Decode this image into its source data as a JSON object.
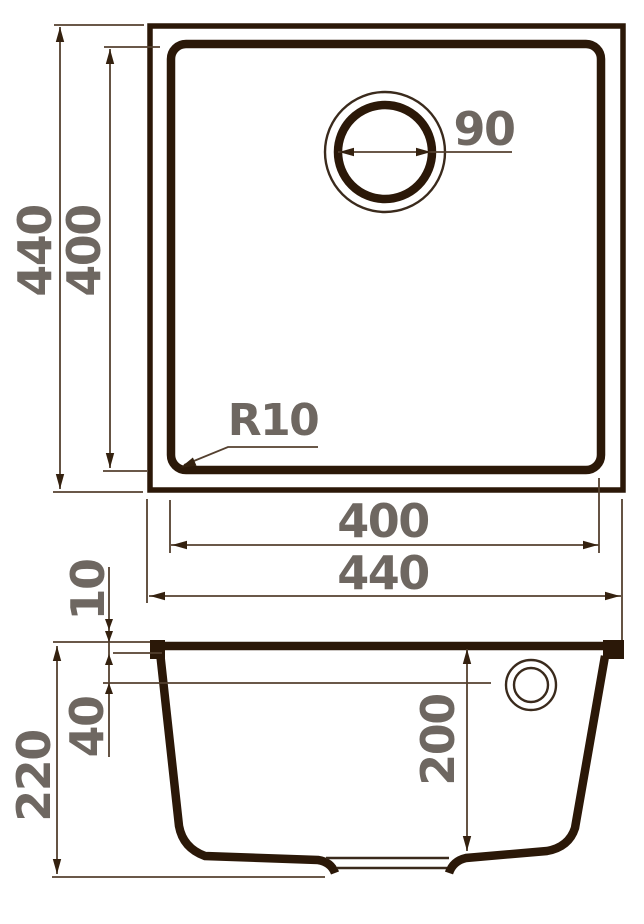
{
  "top_view": {
    "overall_width": "440",
    "overall_height": "440",
    "inner_width": "400",
    "inner_height": "400",
    "drain_diameter": "90",
    "corner_radius": "R10"
  },
  "section_view": {
    "overall_height": "220",
    "rim_thickness": "10",
    "overflow_offset": "40",
    "bowl_depth": "200"
  },
  "colors": {
    "outline": "#2b1808",
    "dimension_line": "#54402f",
    "arrow": "#34210f",
    "label_text": "#6e6761",
    "background": "#ffffff"
  }
}
